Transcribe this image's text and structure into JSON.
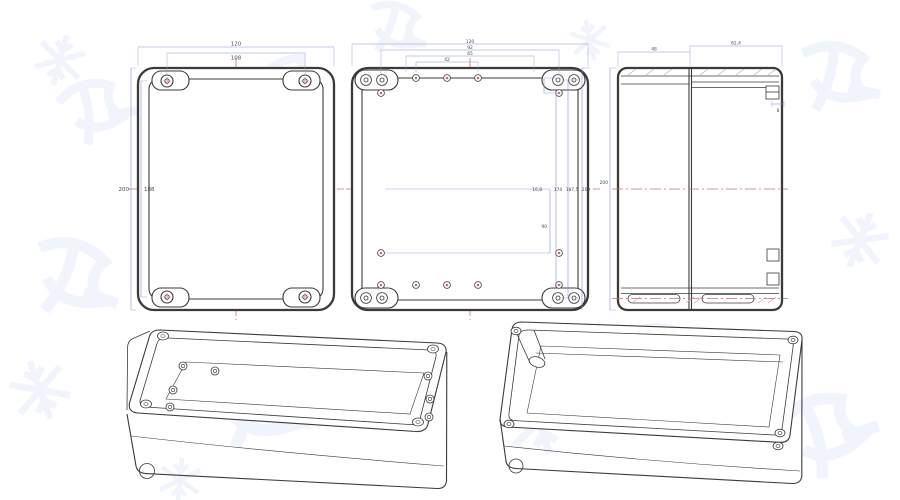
{
  "document": {
    "type": "technical-drawing",
    "subject": "waterproof enclosure box, orthographic and isometric views",
    "views": {
      "front": {
        "label": "front-view-lid",
        "dims": {
          "width_outer": "120",
          "width_inner": "108",
          "height_outer": "200",
          "height_inner": "188"
        }
      },
      "base": {
        "label": "base-inside-view",
        "dims": {
          "width_outer": "120",
          "bolt_span": "92",
          "slot_span": "65",
          "hole_span": "42",
          "row_gap": "16,8",
          "hole_rows": "174",
          "screw_span": "187,5",
          "height_outer": "200",
          "lower_span": "90"
        }
      },
      "side": {
        "label": "side-section-view",
        "dims": {
          "lid_depth": "48",
          "base_depth": "62,4",
          "height": "200",
          "latch": "8"
        }
      },
      "iso_base": {
        "label": "isometric-open-base"
      },
      "iso_lid": {
        "label": "isometric-open-lid"
      }
    },
    "colors": {
      "line": "#3b3b3b",
      "dimension": "#8d8fcf",
      "centerline": "#c4716f",
      "hatch": "#d48fd0",
      "watermark": "#7b93e8",
      "background": "#ffffff"
    }
  }
}
